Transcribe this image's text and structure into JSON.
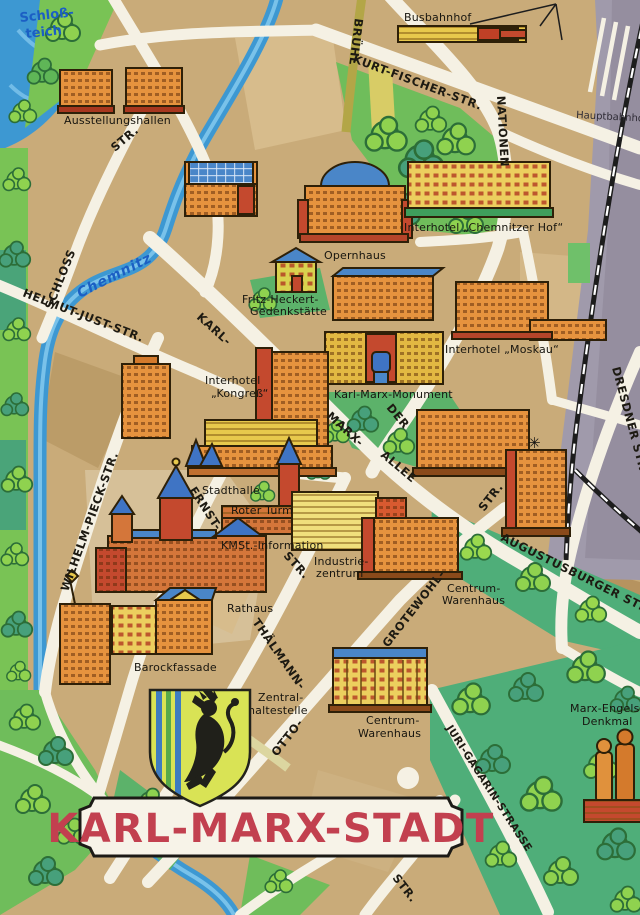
{
  "title": "KARL-MARX-STADT",
  "water": {
    "pond_line1": "Schloß-",
    "pond_line2": "teich",
    "river": "Chemnitz"
  },
  "streets": {
    "kurt_fischer": "KURT-FISCHER-STR.",
    "bruehl": "BRÜHL",
    "nationen": "NATIONEN",
    "der": "DER",
    "schloss": "SCHLOSS",
    "schloss_str_suffix": "STR.",
    "helmut_just": "HELMUT-JUST-STR.",
    "karl": "KARL-",
    "marx": "MARX-",
    "allee": "ALLEE",
    "wilhelm_pieck": "WILHELM-PIECK-STR.",
    "ernst": "ERNST-",
    "ernst_str_suffix": "STR.",
    "thaelmann": "THÄLMANN-",
    "otto": "OTTO-",
    "grotewohl": "GROTEWOHL-",
    "grotewohl_str_suffix": "STR.",
    "augustusburger": "AUGUSTUSBURGER STR.",
    "dresdner": "DRESDNER STR.",
    "juri_gagarin": "JURI-GAGARIN-STRASSE",
    "str_bottom": "STR."
  },
  "places": {
    "ausstellungshallen": {
      "label": "Ausstellungshallen"
    },
    "busbahnhof": {
      "label": "Busbahnhof"
    },
    "hauptbahnhof": {
      "label": "Hauptbahnhof"
    },
    "opernhaus": {
      "label": "Opernhaus"
    },
    "chemnitzer_hof": {
      "label": "Interhotel „Chemnitzer Hof“"
    },
    "fritz_heckert": {
      "line1": "Fritz-Heckert-",
      "line2": "Gedenkstätte"
    },
    "moskau": {
      "label": "Interhotel „Moskau“"
    },
    "kongress": {
      "line1": "Interhotel",
      "line2": "„Kongreß“"
    },
    "karl_marx_monument": {
      "label": "Karl-Marx-Monument"
    },
    "stadthalle": {
      "label": "Stadthalle"
    },
    "roter_turm": {
      "label": "Roter Turm"
    },
    "kmst_information": {
      "label": "KMSt.-Information"
    },
    "industriezentrum": {
      "line1": "Industrie-",
      "line2": "zentrum"
    },
    "rathaus": {
      "label": "Rathaus"
    },
    "barockfassade": {
      "label": "Barockfassade"
    },
    "centrum_warenhaus_nord": {
      "line1": "Centrum-",
      "line2": "Warenhaus"
    },
    "zentralhaltestelle": {
      "line1": "Zentral-",
      "line2": "haltestelle"
    },
    "centrum_warenhaus_sued": {
      "line1": "Centrum-",
      "line2": "Warenhaus"
    },
    "marx_engels_denkmal": {
      "line1": "Marx-Engels-",
      "line2": "Denkmal"
    }
  },
  "map_symbols": {
    "star": "✳"
  },
  "colors": {
    "land": "#c9ab79",
    "street": "#f5f1e4",
    "water": "#3d98d2",
    "park_light": "#79c355",
    "park_teal": "#4fae79",
    "building_orange": "#e6933e",
    "building_red": "#c4492e",
    "building_yellow": "#eccf5e",
    "roof_blue": "#4a86c8",
    "railway_gray": "#a09aab",
    "title_red": "#c2404f"
  }
}
